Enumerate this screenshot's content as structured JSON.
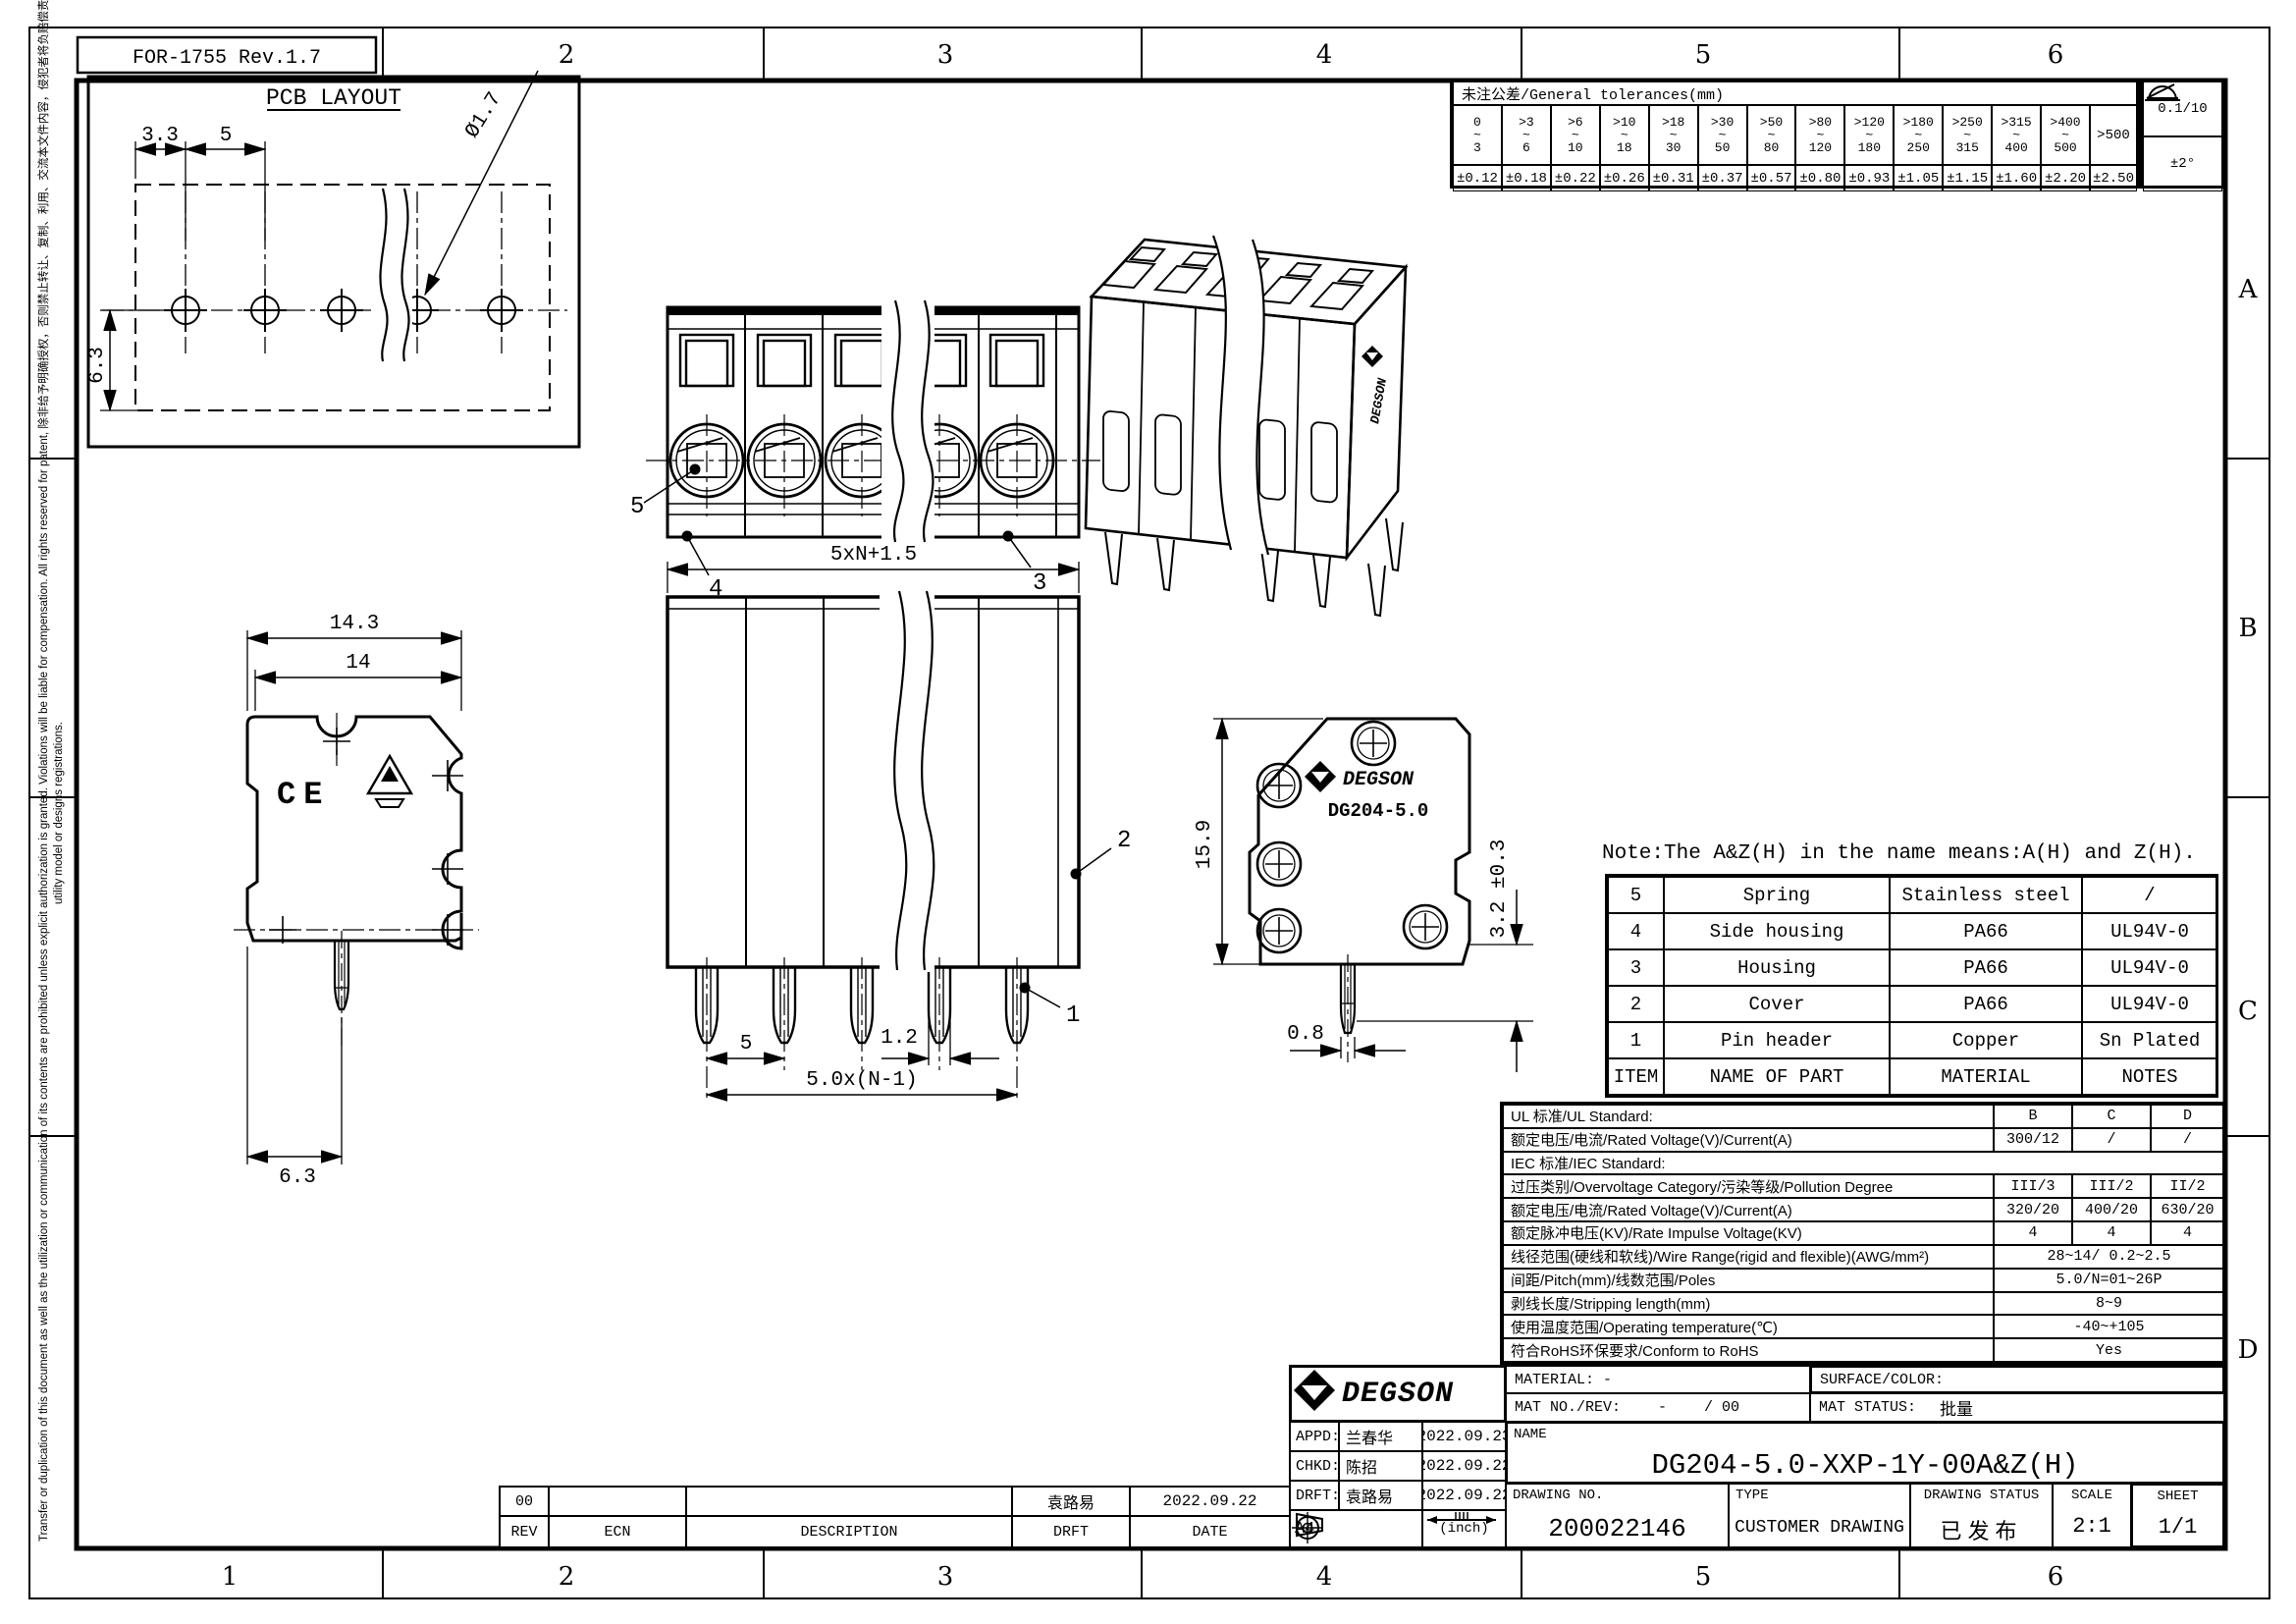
{
  "sheet": {
    "form_ref": "FOR-1755 Rev.1.7",
    "colors": {
      "ink": "#000000",
      "paper": "#ffffff"
    },
    "zones": {
      "top": [
        "2",
        "3",
        "4",
        "5",
        "6"
      ],
      "bottom": [
        "1",
        "2",
        "3",
        "4",
        "5",
        "6"
      ],
      "right": [
        "A",
        "B",
        "C",
        "D"
      ]
    },
    "disclaimer_line1": "Transfer or duplication of this document as well as the utilization or communication of its contents are prohibited unless explicit authorization is granted. Violations will be liable for compensation. All rights reserved for patent,  除非给予明确授权，否则禁止转让、复制、利用、交流本文件内容，侵犯者将负赔偿责任。本公司保留对专利发明、实用新型和外观专利的所有权利。",
    "disclaimer_line2": "utility model or designs registrations."
  },
  "tolerances": {
    "title": "未注公差/General tolerances(mm)",
    "tilde": "~",
    "ranges": [
      {
        "f": "0",
        "t": "3"
      },
      {
        "f": ">3",
        "t": "6"
      },
      {
        "f": ">6",
        "t": "10"
      },
      {
        "f": ">10",
        "t": "18"
      },
      {
        "f": ">18",
        "t": "30"
      },
      {
        "f": ">30",
        "t": "50"
      },
      {
        "f": ">50",
        "t": "80"
      },
      {
        "f": ">80",
        "t": "120"
      },
      {
        "f": ">120",
        "t": "180"
      },
      {
        "f": ">180",
        "t": "250"
      },
      {
        "f": ">250",
        "t": "315"
      },
      {
        "f": ">315",
        "t": "400"
      },
      {
        "f": ">400",
        "t": "500"
      }
    ],
    "values": [
      "±0.12",
      "±0.18",
      "±0.22",
      "±0.26",
      "±0.31",
      "±0.37",
      "±0.57",
      "±0.80",
      "±0.93",
      "±1.05",
      "±1.15",
      "±1.60",
      "±2.20"
    ],
    "over500": {
      "label": ">500",
      "value": "±2.50"
    },
    "flatness": "0.1/10",
    "angle": "±2°"
  },
  "pcb_layout": {
    "title": "PCB LAYOUT",
    "pitch_a": "3.3",
    "pitch_b": "5",
    "row_offset": "6.3",
    "hole_dia": "Ø1.7"
  },
  "dims": {
    "side_overall": "14.3",
    "side_body": "14",
    "side_pin_offset": "6.3",
    "front_width": "5xN+1.5",
    "front_pitch": "5",
    "front_pin_w": "1.2",
    "front_span": "5.0x(N-1)",
    "end_height": "15.9",
    "end_pin_len": "3.2 ±0.3",
    "end_pin_w": "0.8"
  },
  "callouts": {
    "c1": "1",
    "c2": "2",
    "c3": "3",
    "c4": "4",
    "c5": "5"
  },
  "marks": {
    "ce": "CE",
    "brand": "DEGSON",
    "model": "DG204-5.0"
  },
  "note": "Note:The A&Z(H) in the name means:A(H) and Z(H).",
  "parts_table": {
    "headers": {
      "item": "ITEM",
      "name": "NAME OF PART",
      "material": "MATERIAL",
      "notes": "NOTES"
    },
    "rows": [
      {
        "item": "5",
        "name": "Spring",
        "material": "Stainless steel",
        "notes": "/"
      },
      {
        "item": "4",
        "name": "Side housing",
        "material": "PA66",
        "notes": "UL94V-0"
      },
      {
        "item": "3",
        "name": "Housing",
        "material": "PA66",
        "notes": "UL94V-0"
      },
      {
        "item": "2",
        "name": "Cover",
        "material": "PA66",
        "notes": "UL94V-0"
      },
      {
        "item": "1",
        "name": "Pin header",
        "material": "Copper",
        "notes": "Sn Plated"
      }
    ]
  },
  "spec_table": {
    "rows": [
      {
        "label": "UL 标准/UL Standard:",
        "b": "B",
        "c": "C",
        "d": "D"
      },
      {
        "label": "额定电压/电流/Rated Voltage(V)/Current(A)",
        "b": "300/12",
        "c": "/",
        "d": "/"
      },
      {
        "label": "IEC 标准/IEC Standard:"
      },
      {
        "label": "过压类别/Overvoltage Category/污染等级/Pollution Degree",
        "b": "III/3",
        "c": "III/2",
        "d": "II/2"
      },
      {
        "label": "额定电压/电流/Rated Voltage(V)/Current(A)",
        "b": "320/20",
        "c": "400/20",
        "d": "630/20"
      },
      {
        "label": "额定脉冲电压(KV)/Rate Impulse Voltage(KV)",
        "b": "4",
        "c": "4",
        "d": "4"
      },
      {
        "label": "线径范围(硬线和软线)/Wire Range(rigid and flexible)(AWG/mm²)",
        "merged": "28~14/ 0.2~2.5"
      },
      {
        "label": "间距/Pitch(mm)/线数范围/Poles",
        "merged": "5.0/N=01~26P"
      },
      {
        "label": "剥线长度/Stripping length(mm)",
        "merged": "8~9"
      },
      {
        "label": "使用温度范围/Operating temperature(℃)",
        "merged": "-40~+105"
      },
      {
        "label": "符合RoHS环保要求/Conform to RoHS",
        "merged": "Yes"
      }
    ]
  },
  "title_block": {
    "brand": "DEGSON",
    "appd_label": "APPD:",
    "appd_name": "兰春华",
    "appd_date": "2022.09.23",
    "chkd_label": "CHKD:",
    "chkd_name": "陈招",
    "chkd_date": "2022.09.22",
    "drft_label": "DRFT:",
    "drft_name": "袁路易",
    "drft_date": "2022.09.22",
    "paper_size": "A4",
    "unit_label": "(inch)",
    "material_label": "MATERIAL: -",
    "mat_no_label": "MAT NO./REV:",
    "mat_no_value": "-",
    "mat_rev_value": "/ 00",
    "surface_label": "SURFACE/COLOR:",
    "mat_status_label": "MAT STATUS:",
    "mat_status_value": "批量",
    "name_label": "NAME",
    "part_name": "DG204-5.0-XXP-1Y-00A&Z(H)",
    "drawing_no_label": "DRAWING NO.",
    "drawing_no": "200022146",
    "type_label": "TYPE",
    "type_value": "CUSTOMER DRAWING",
    "status_label": "DRAWING STATUS",
    "status_value": "已发布",
    "scale_label": "SCALE",
    "scale_value": "2:1",
    "sheet_label": "SHEET",
    "sheet_value": "1/1"
  },
  "revision_table": {
    "headers": {
      "rev": "REV",
      "ecn": "ECN",
      "description": "DESCRIPTION",
      "drft": "DRFT",
      "date": "DATE"
    },
    "row": {
      "rev": "00",
      "ecn": "",
      "description": "",
      "drft": "袁路易",
      "date": "2022.09.22"
    }
  }
}
